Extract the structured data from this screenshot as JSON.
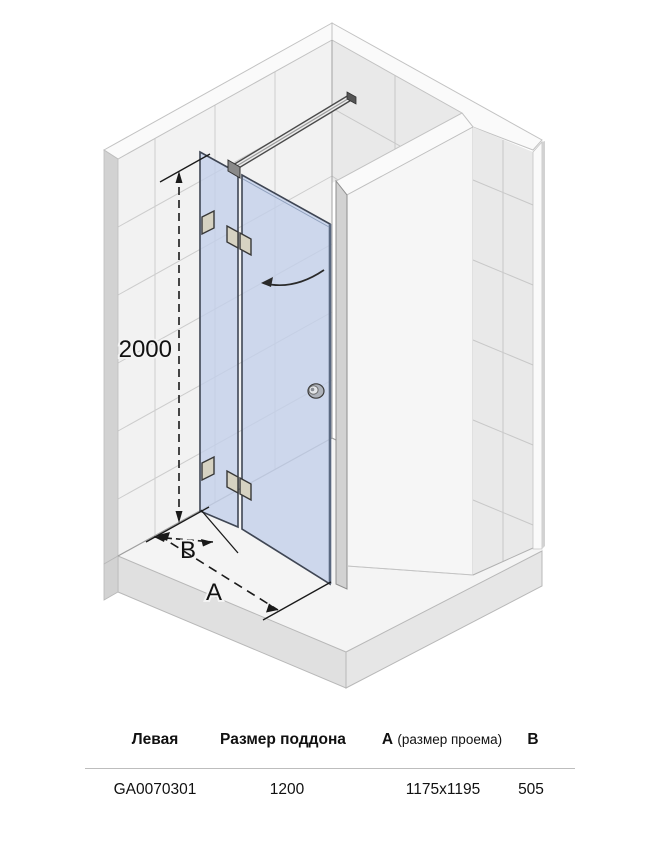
{
  "colors": {
    "glass": "#c3d0ea",
    "glass_edge": "#3f4654",
    "wall_left": "#f2f2f2",
    "wall_right": "#e9e9e9",
    "partition_face": "#f6f6f6",
    "band": "#fafafa",
    "side_strip": "#d2d2d2",
    "floor": "#f4f4f4",
    "slab_front": "#e0e0e0",
    "slab_side": "#e6e6e6",
    "hinge": "#d6d2c2",
    "bar_dark": "#4a4a4a",
    "dim_line": "#1a1a1a"
  },
  "diagram": {
    "height_dimension": "2000",
    "depth_dimension_label": "B",
    "width_dimension_label": "A"
  },
  "table": {
    "headers": {
      "orientation": "Левая",
      "tray_size": "Размер поддона",
      "a_label": "А",
      "a_note": "(размер проема)",
      "b_label": "В"
    },
    "row": {
      "article": "GA0070301",
      "tray_size": "1200",
      "a_value": "1175x1195",
      "b_value": "505"
    }
  }
}
